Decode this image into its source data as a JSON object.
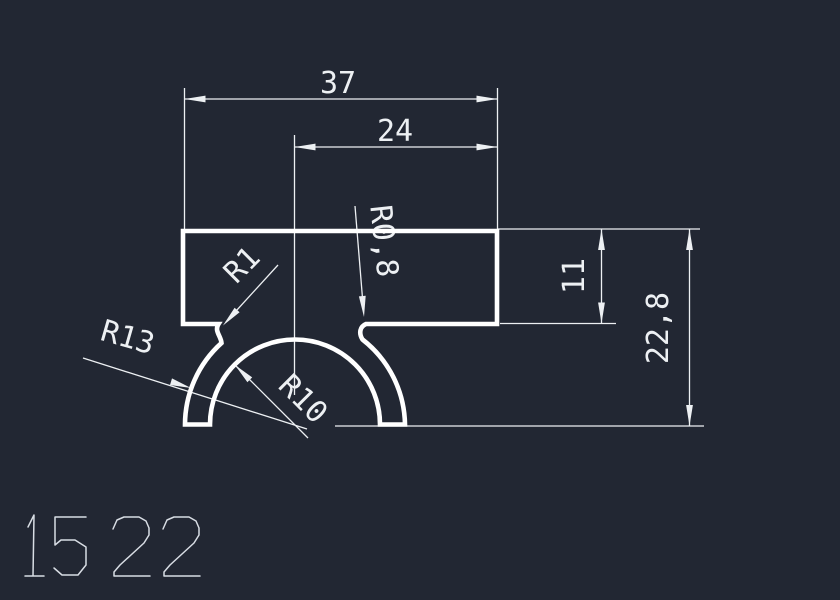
{
  "drawing": {
    "part_number": "1522",
    "dimensions": {
      "total_width": "37",
      "offset_width": "24",
      "rect_height": "11",
      "total_height": "22,8"
    },
    "radii": {
      "fillet_left": "R1",
      "fillet_right": "R0,8",
      "outer": "R13",
      "inner": "R10"
    },
    "colors": {
      "background": "#222733",
      "profile_line": "#ffffff",
      "dimension_line": "#edf0f3",
      "part_number_text": "#d8dde4"
    }
  }
}
